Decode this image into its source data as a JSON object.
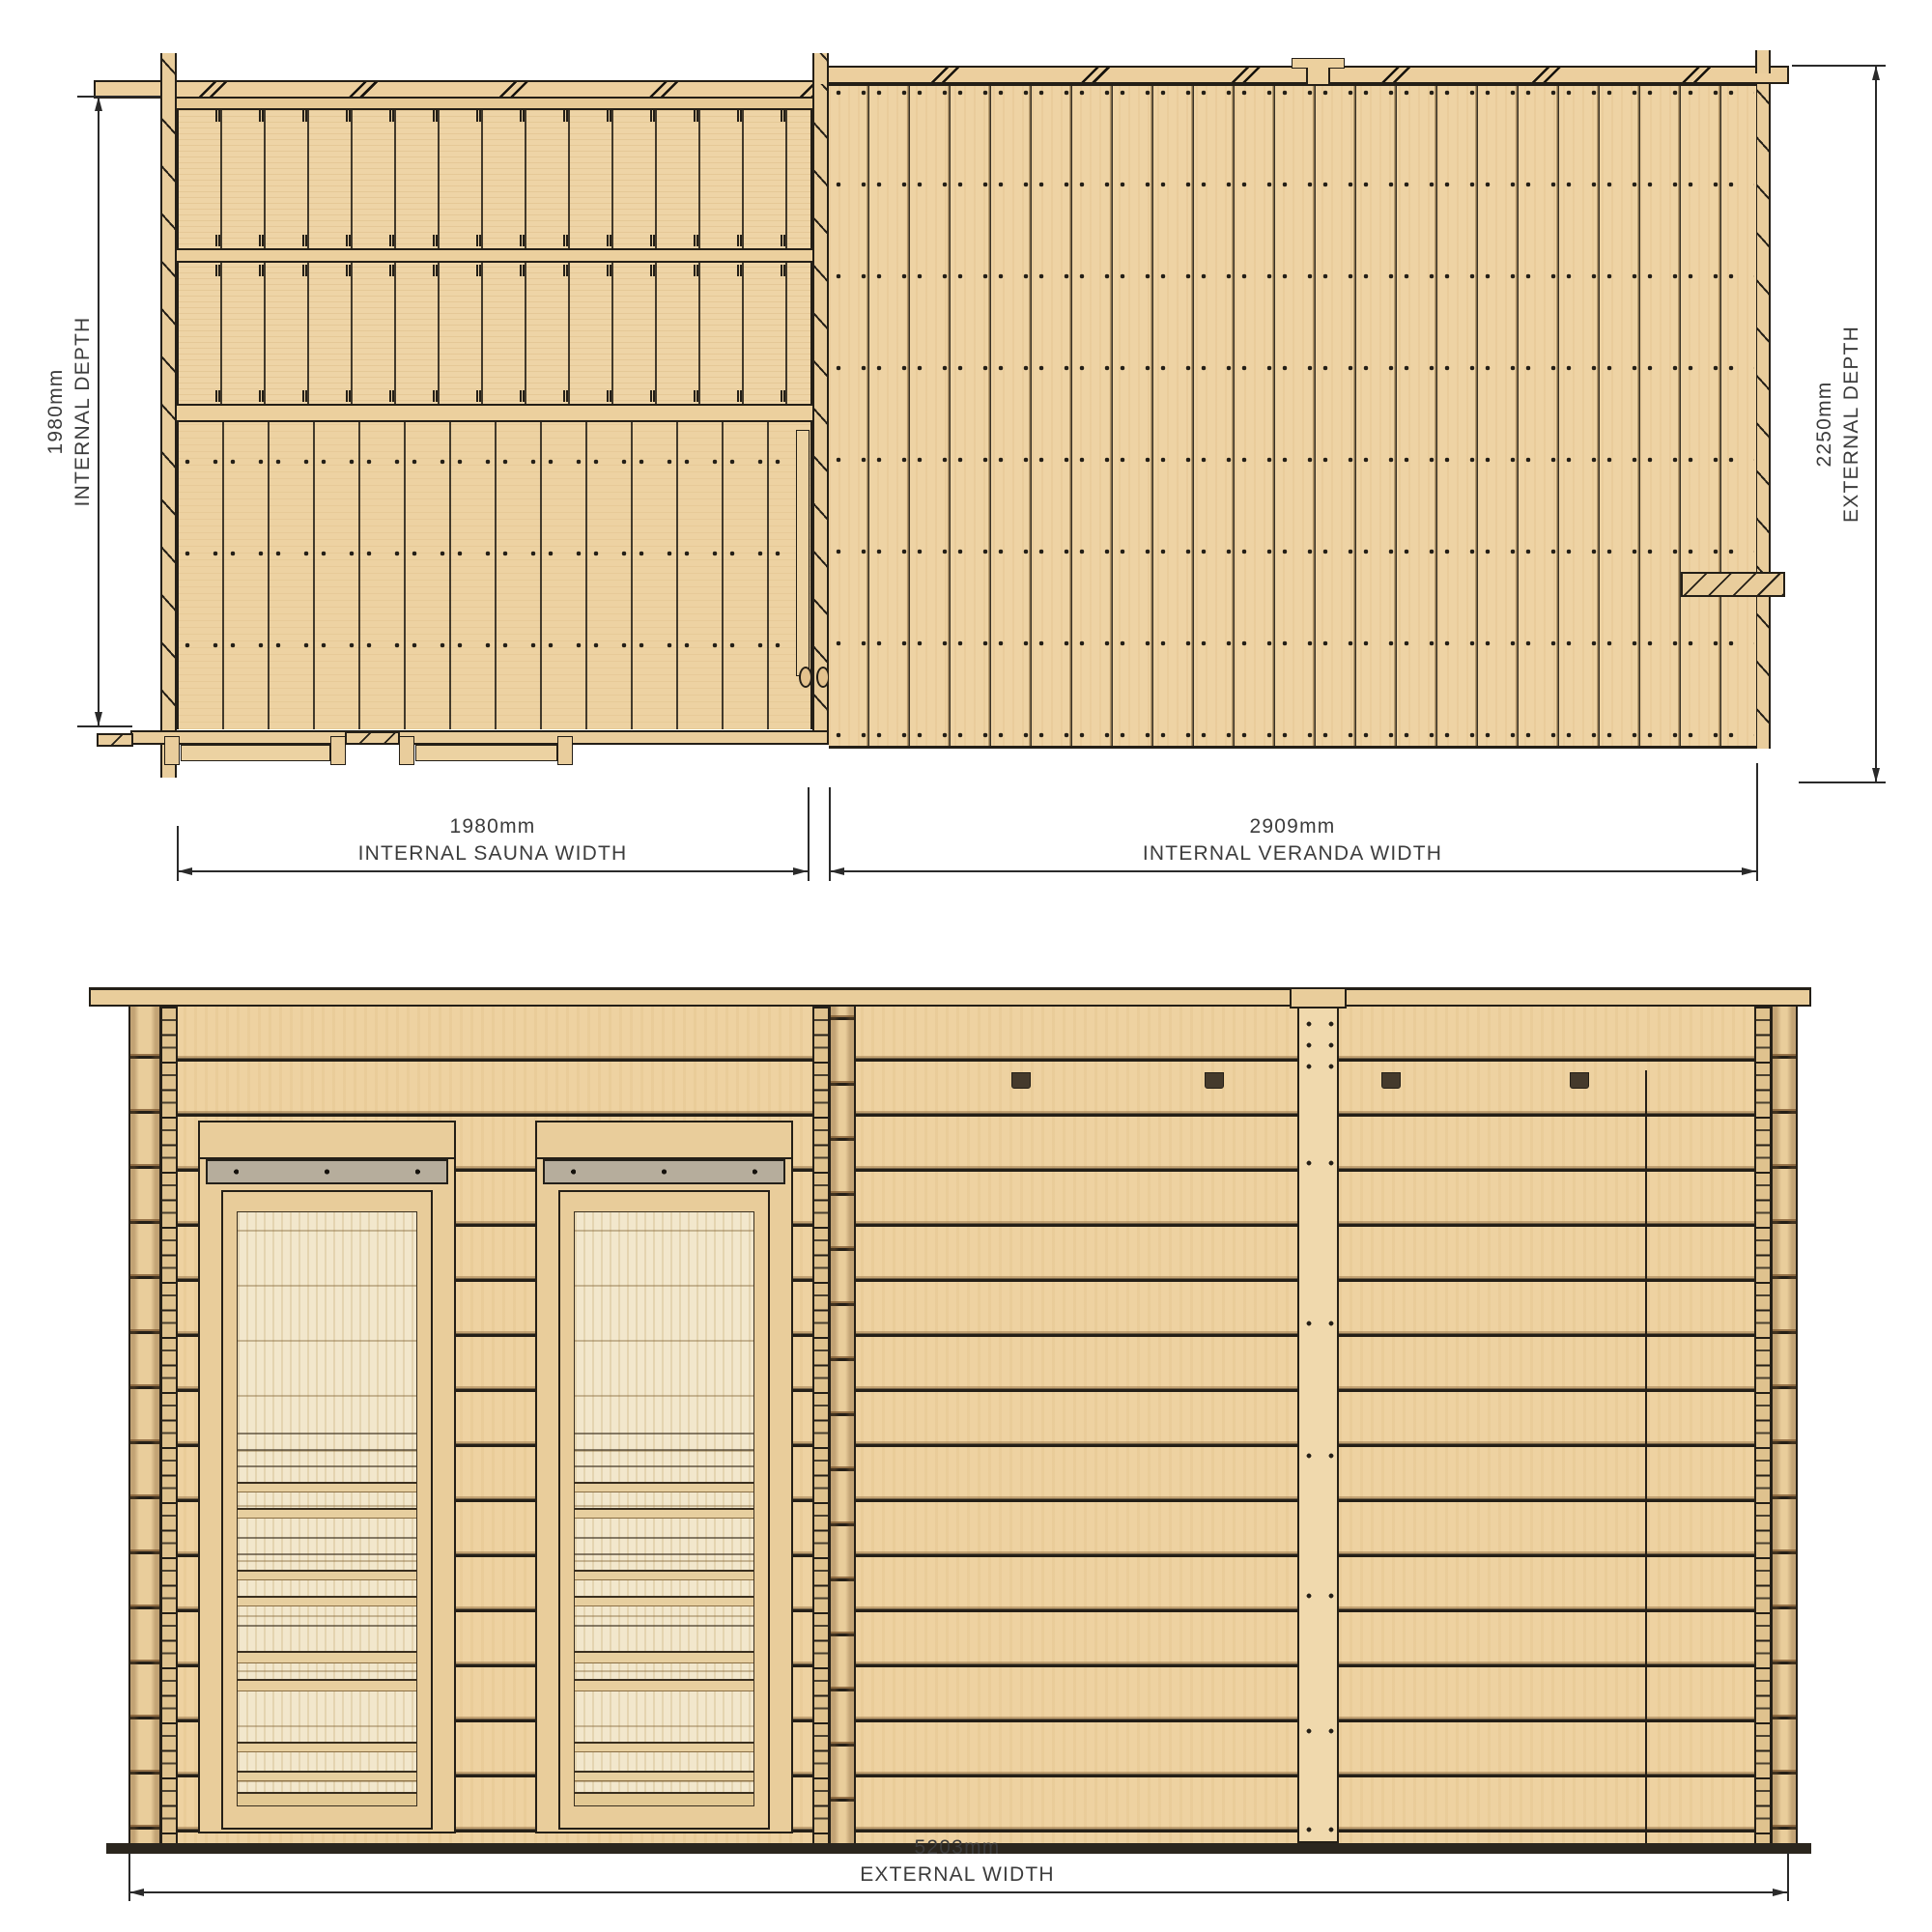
{
  "document": {
    "type": "technical-drawing",
    "subject": "log cabin sauna with veranda",
    "sheet_background": "#ffffff"
  },
  "views": {
    "plan": {
      "name": "plan-view"
    },
    "front_elevation": {
      "name": "front-elevation-view"
    }
  },
  "dimensions": {
    "internal_depth": {
      "value": "1980mm",
      "label": "INTERNAL DEPTH"
    },
    "external_depth": {
      "value": "2250mm",
      "label": "EXTERNAL DEPTH"
    },
    "internal_sauna_width": {
      "value": "1980mm",
      "label": "INTERNAL SAUNA WIDTH"
    },
    "internal_veranda_width": {
      "value": "2909mm",
      "label": "INTERNAL VERANDA WIDTH"
    },
    "external_width": {
      "value": "5203mm",
      "label": "EXTERNAL WIDTH"
    }
  },
  "colors": {
    "wood": "#eed2a1",
    "wood_line": "#241f17",
    "glass": "#f2e7cc",
    "transom_bar": "#b6ad9c",
    "vent": "#453a2c",
    "dimension_text": "#3c3c3c"
  }
}
